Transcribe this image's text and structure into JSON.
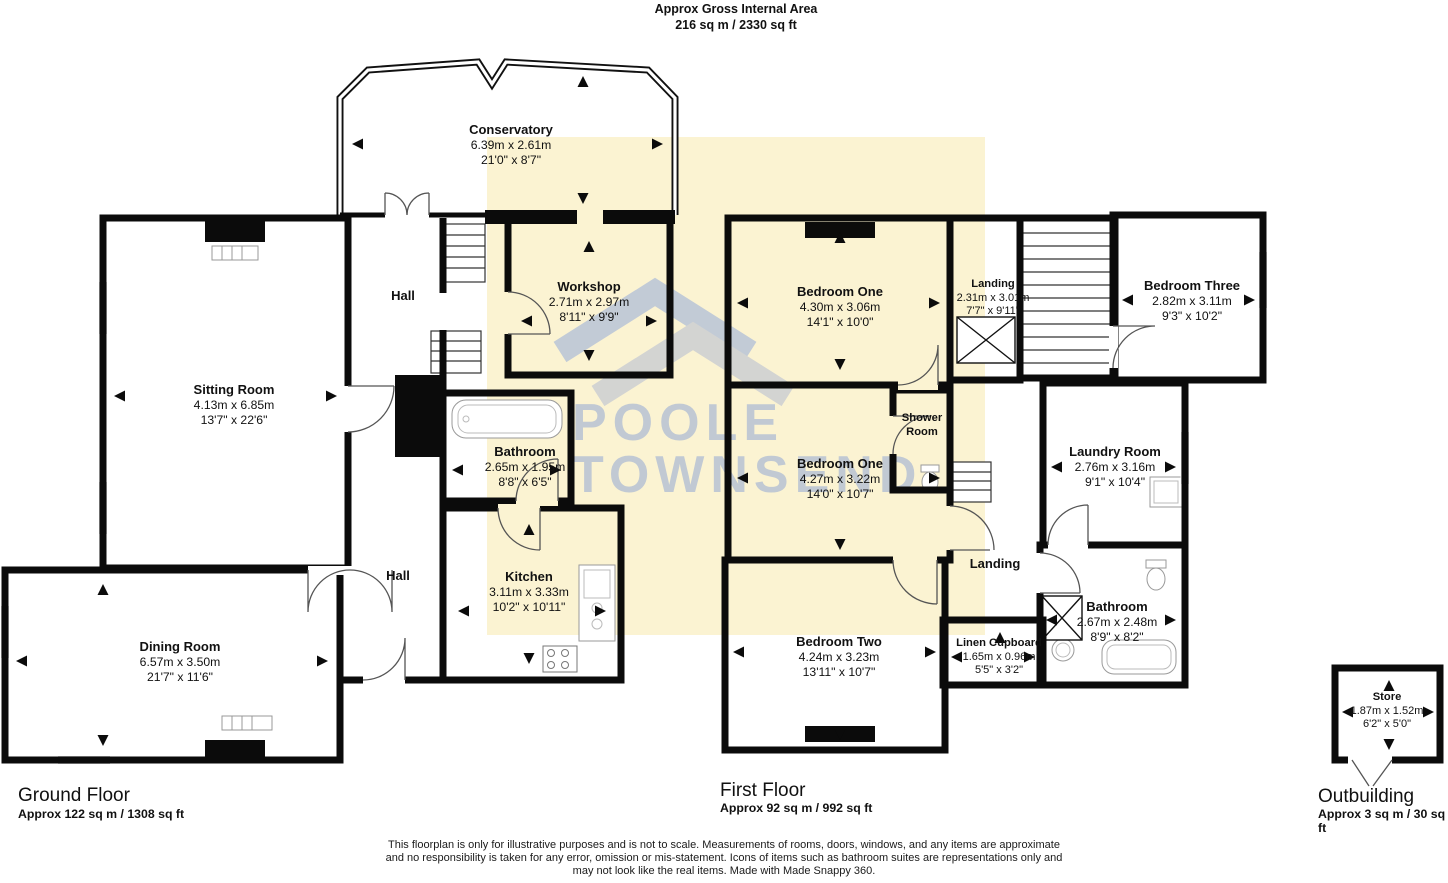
{
  "header": {
    "title": "Approx Gross Internal Area",
    "area": "216 sq m / 2330 sq ft"
  },
  "floors": {
    "ground": {
      "label": "Ground Floor",
      "area": "Approx 122 sq m / 1308 sq ft"
    },
    "first": {
      "label": "First Floor",
      "area": "Approx 92 sq m / 992 sq ft"
    },
    "outbuilding": {
      "label": "Outbuilding",
      "area": "Approx 3 sq m / 30 sq ft"
    }
  },
  "rooms": {
    "conservatory": {
      "name": "Conservatory",
      "metric": "6.39m x 2.61m",
      "imperial": "21'0\" x 8'7\""
    },
    "hall_upper": {
      "name": "Hall"
    },
    "hall_lower": {
      "name": "Hall"
    },
    "sitting_room": {
      "name": "Sitting Room",
      "metric": "4.13m x 6.85m",
      "imperial": "13'7\" x 22'6\""
    },
    "workshop": {
      "name": "Workshop",
      "metric": "2.71m x 2.97m",
      "imperial": "8'11\" x 9'9\""
    },
    "bathroom_gf": {
      "name": "Bathroom",
      "metric": "2.65m x 1.95m",
      "imperial": "8'8\" x 6'5\""
    },
    "kitchen": {
      "name": "Kitchen",
      "metric": "3.11m x 3.33m",
      "imperial": "10'2\" x 10'11\""
    },
    "dining_room": {
      "name": "Dining Room",
      "metric": "6.57m x 3.50m",
      "imperial": "21'7\" x 11'6\""
    },
    "bedroom_one_a": {
      "name": "Bedroom One",
      "metric": "4.30m x 3.06m",
      "imperial": "14'1\" x 10'0\""
    },
    "landing_ff": {
      "name": "Landing",
      "metric": "2.31m x 3.01m",
      "imperial": "7'7\" x 9'11\""
    },
    "bedroom_three": {
      "name": "Bedroom Three",
      "metric": "2.82m x 3.11m",
      "imperial": "9'3\" x 10'2\""
    },
    "shower_room": {
      "name": "Shower Room"
    },
    "bedroom_one_b": {
      "name": "Bedroom One",
      "metric": "4.27m x 3.22m",
      "imperial": "14'0\" x 10'7\""
    },
    "laundry_room": {
      "name": "Laundry Room",
      "metric": "2.76m x 3.16m",
      "imperial": "9'1\" x 10'4\""
    },
    "landing_lower": {
      "name": "Landing"
    },
    "bathroom_ff": {
      "name": "Bathroom",
      "metric": "2.67m x 2.48m",
      "imperial": "8'9\" x 8'2\""
    },
    "linen_cupboard": {
      "name": "Linen Cupboard",
      "metric": "1.65m x 0.96m",
      "imperial": "5'5\" x 3'2\""
    },
    "bedroom_two": {
      "name": "Bedroom Two",
      "metric": "4.24m x 3.23m",
      "imperial": "13'11\" x 10'7\""
    },
    "store": {
      "name": "Store",
      "metric": "1.87m x 1.52m",
      "imperial": "6'2\" x 5'0\""
    }
  },
  "watermark": {
    "line1": "POOLE",
    "line2": "TOWNSEND"
  },
  "disclaimer": {
    "line1": "This floorplan is only for illustrative purposes and is not to scale. Measurements of rooms, doors, windows, and any items are approximate",
    "line2": "and no responsibility is taken for any error, omission or mis-statement. Icons of items such as bathroom suites are representations only and",
    "line3": "may not look like the real items. Made with Made Snappy 360."
  },
  "colors": {
    "highlight": "#FBF3D2",
    "wall": "#0B0B0B",
    "watermark": "#AEBCD4"
  }
}
